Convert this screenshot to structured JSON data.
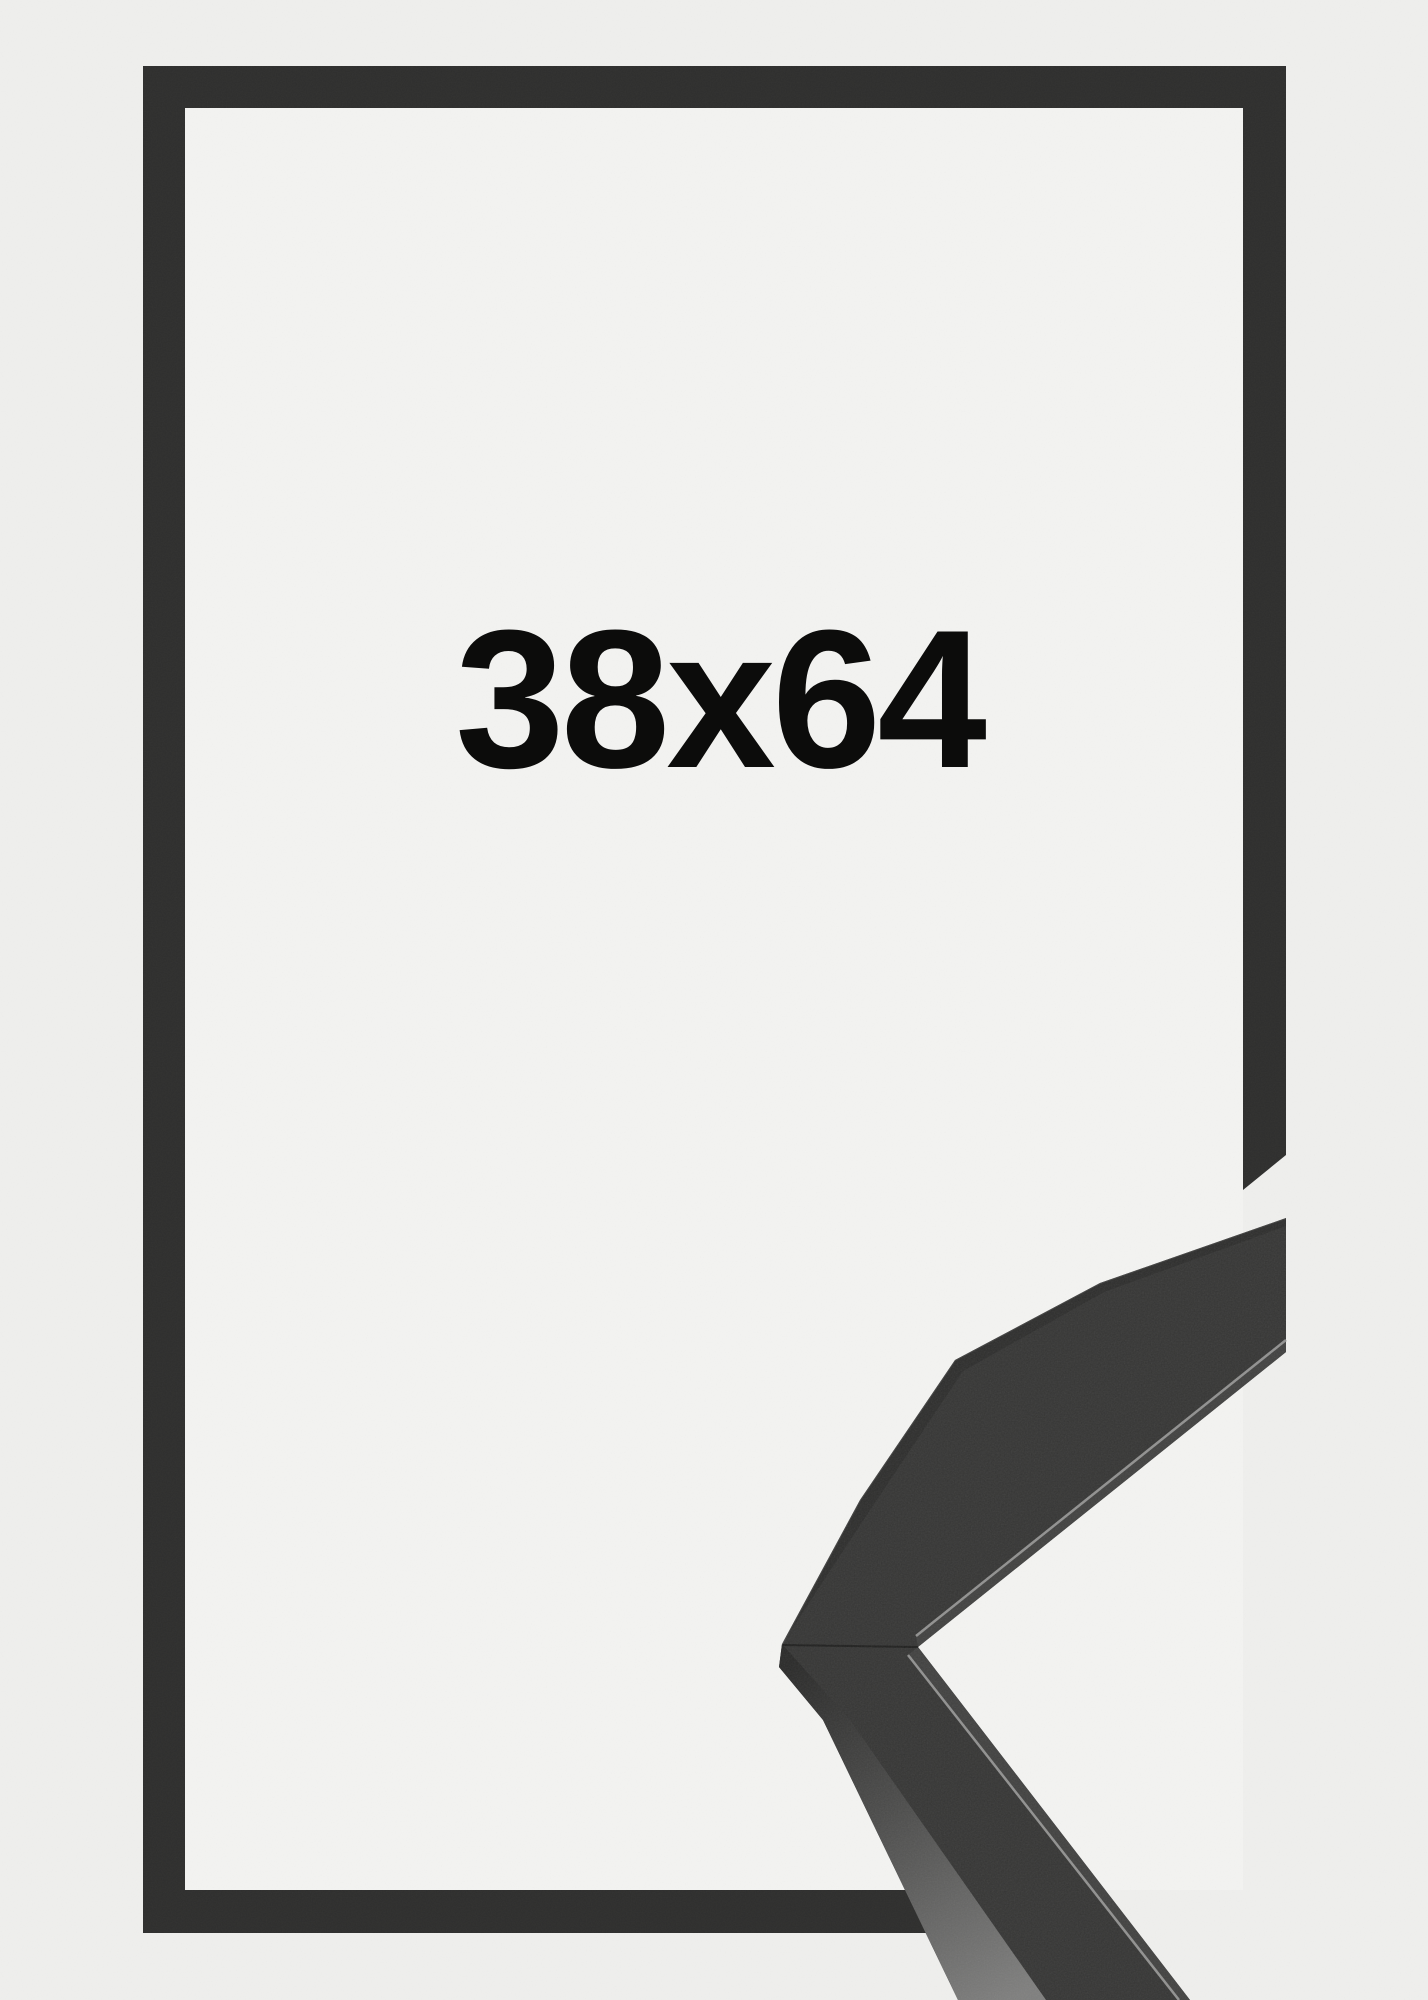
{
  "product_photo": {
    "size_label": "38x64",
    "colors": {
      "background_outer": "#efefed",
      "background_inner": "#f3f3f1",
      "frame": "#2e2e2d",
      "detail_top_face": "#333332",
      "detail_side_face_dark": "#272726",
      "detail_side_face_light": "#7d7d7c",
      "detail_lip": "#3f3f3e",
      "detail_lip_highlight": "#90908f",
      "label_text": "#0c0c0b"
    }
  }
}
